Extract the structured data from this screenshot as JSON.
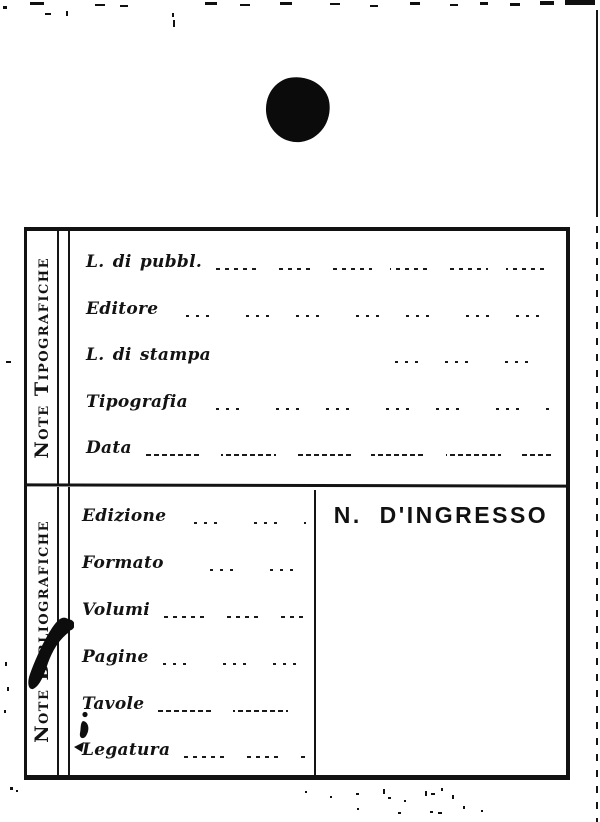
{
  "card": {
    "sections": [
      {
        "id": "tipografiche",
        "label": "Note Tipografiche",
        "fields": [
          {
            "label": "L. di pubbl.",
            "value": ""
          },
          {
            "label": "Editore",
            "value": ""
          },
          {
            "label": "L. di stampa",
            "value": ""
          },
          {
            "label": "Tipografia",
            "value": ""
          },
          {
            "label": "Data",
            "value": ""
          }
        ]
      },
      {
        "id": "bibliografiche",
        "label": "Note Bibliografiche",
        "fields": [
          {
            "label": "Edizione",
            "value": ""
          },
          {
            "label": "Formato",
            "value": ""
          },
          {
            "label": "Volumi",
            "value": ""
          },
          {
            "label": "Pagine",
            "value": ""
          },
          {
            "label": "Tavole",
            "value": ""
          },
          {
            "label": "Legatura",
            "value": ""
          }
        ]
      }
    ],
    "ingresso_title": "N. D'INGRESSO"
  },
  "colors": {
    "ink": "#121212",
    "paper": "#ffffff"
  }
}
